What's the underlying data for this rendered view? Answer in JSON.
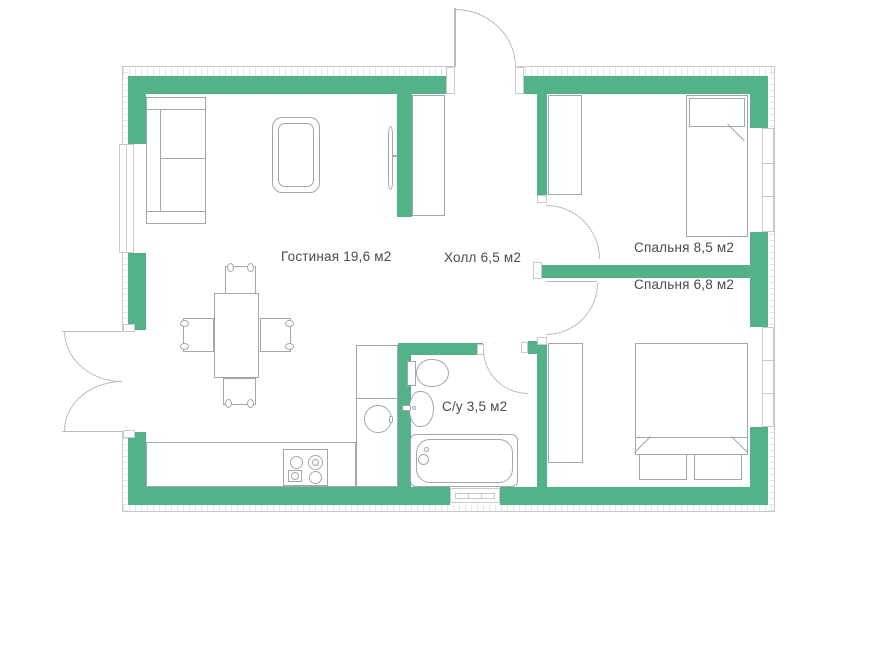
{
  "plan": {
    "type": "apartment-floor-plan",
    "rooms": [
      {
        "id": "living-room",
        "name": "Гостиная",
        "area": "19,6 м2",
        "label": "Гостиная 19,6 м2"
      },
      {
        "id": "hall",
        "name": "Холл",
        "area": "6,5 м2",
        "label": "Холл 6,5 м2"
      },
      {
        "id": "bedroom-1",
        "name": "Спальня",
        "area": "8,5 м2",
        "label": "Спальня 8,5 м2"
      },
      {
        "id": "bedroom-2",
        "name": "Спальня",
        "area": "6,8 м2",
        "label": "Спальня 6,8 м2"
      },
      {
        "id": "bathroom",
        "name": "С/у",
        "area": "3,5 м2",
        "label": "С/у 3,5 м2"
      }
    ]
  },
  "colors": {
    "wall": "#53b287",
    "line": "#a3a7aa",
    "outline": "#c6cacc",
    "door": "#b9bdbf",
    "text": "#4a4a4a",
    "bg": "#ffffff"
  }
}
